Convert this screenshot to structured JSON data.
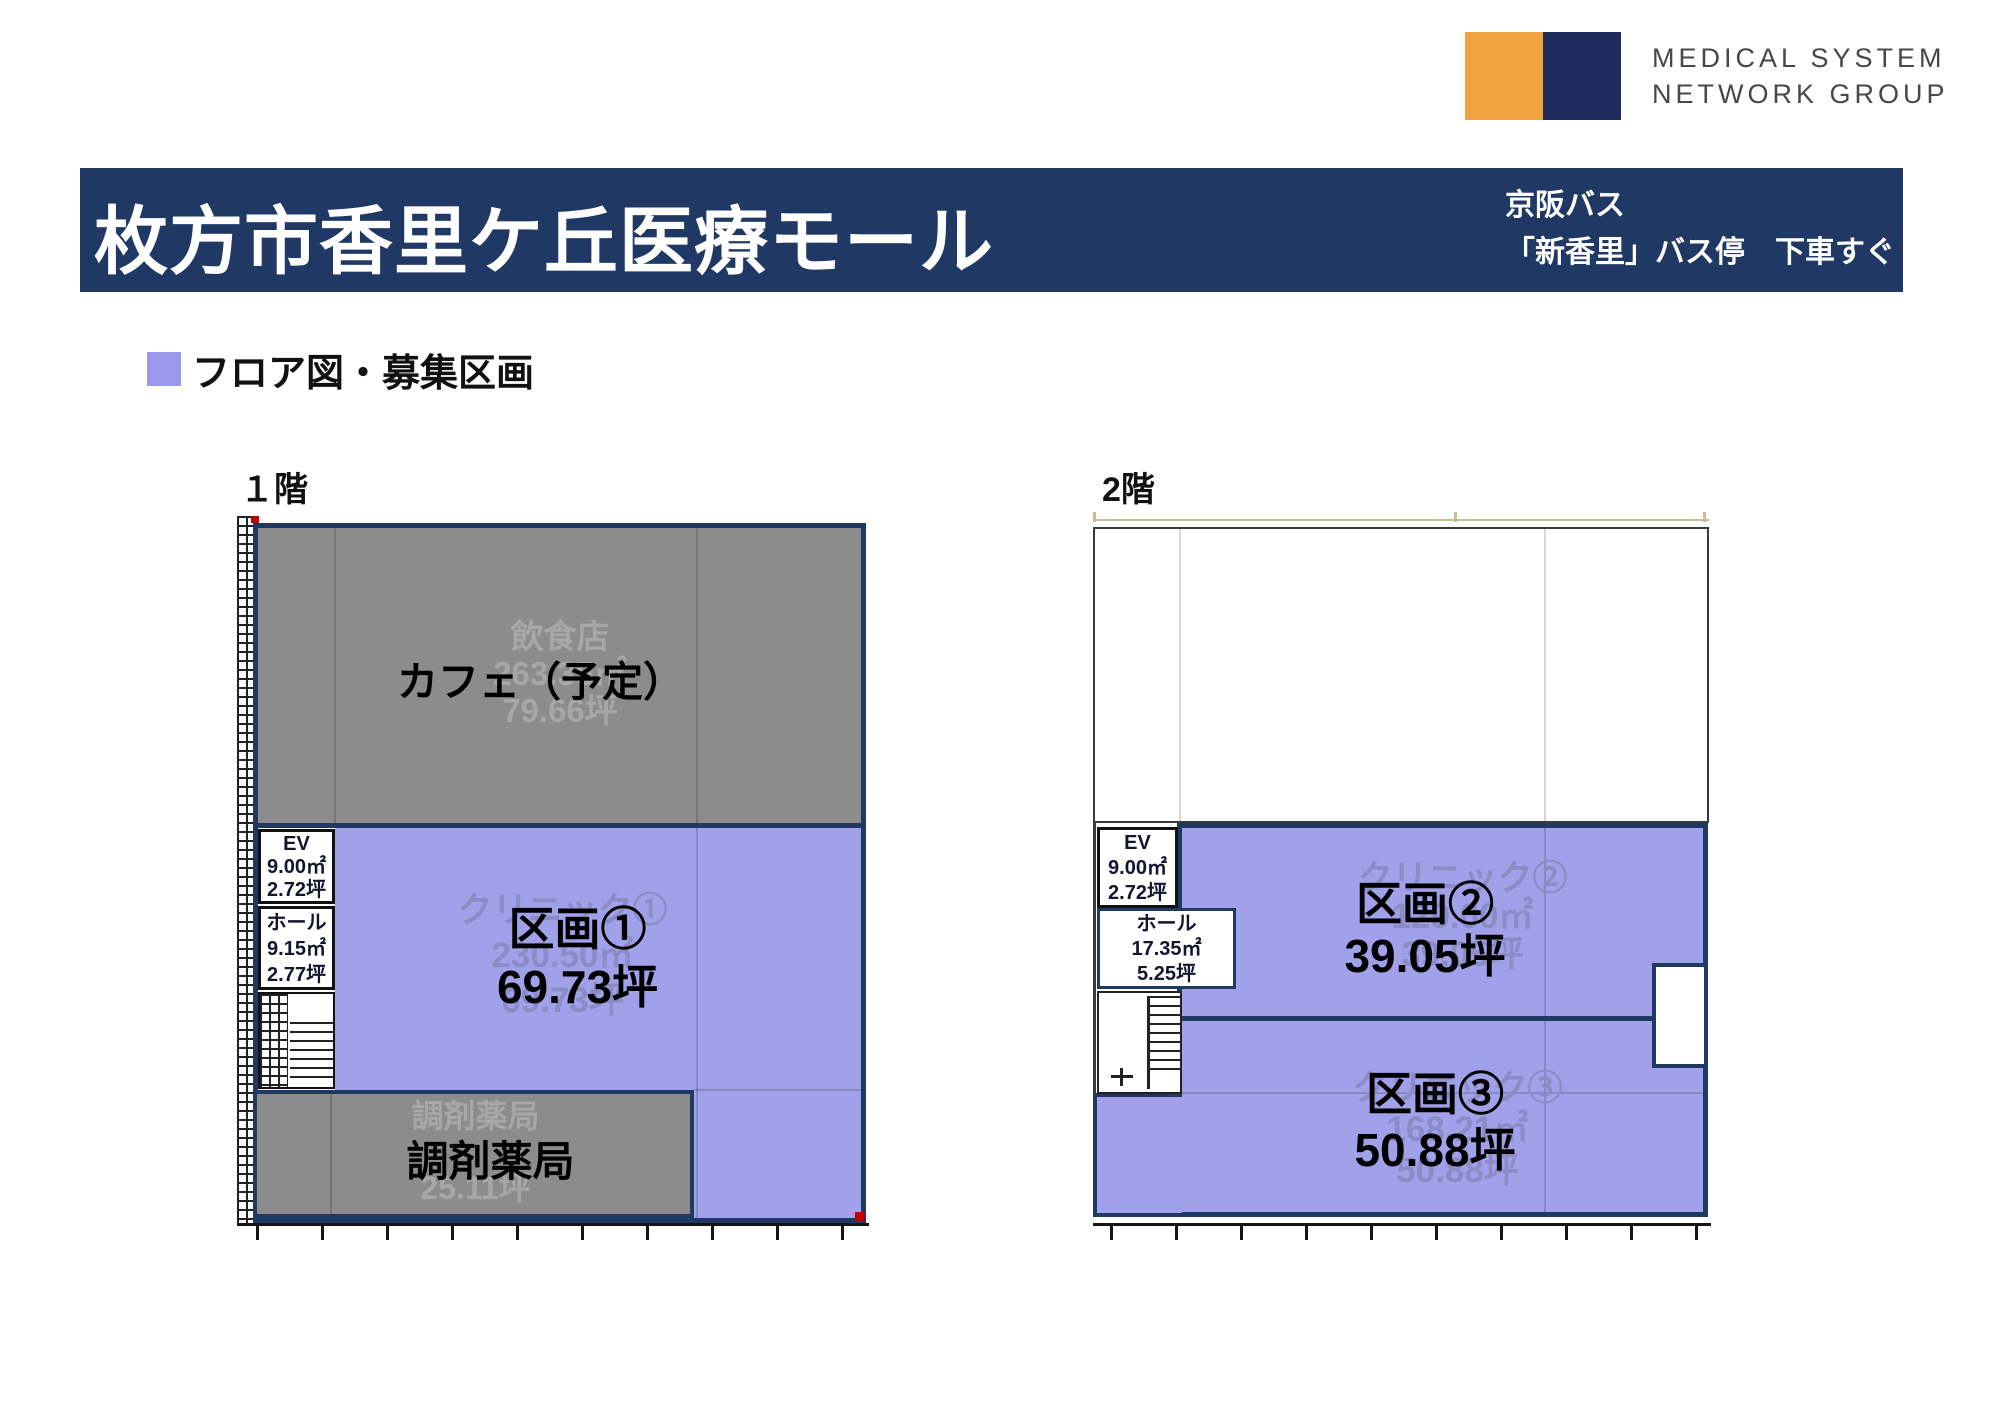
{
  "logo": {
    "orange": "#F0A33C",
    "navy": "#1E2B5C",
    "line1": "MEDICAL SYSTEM",
    "line2": "NETWORK GROUP"
  },
  "header": {
    "bg": "#1F3864",
    "title": "枚方市香里ケ丘医療モール",
    "access_line1": "京阪バス",
    "access_line2": "「新香里」バス停　下車すぐ"
  },
  "section": {
    "bullet_color": "#9999EC",
    "heading": "フロア図・募集区画"
  },
  "floor1": {
    "label": "１階",
    "cafe": {
      "faded1": "飲食店",
      "faded2": "263.35㎡",
      "faded3": "79.66坪",
      "bold": "カフェ（予定）"
    },
    "ev": {
      "l1": "EV",
      "l2": "9.00㎡",
      "l3": "2.72坪"
    },
    "hall": {
      "l1": "ホール",
      "l2": "9.15㎡",
      "l3": "2.77坪"
    },
    "unit1": {
      "faded1": "クリニック①",
      "faded2": "230.50㎡",
      "faded3": "69.73坪",
      "bold1": "区画①",
      "bold2": "69.73坪"
    },
    "pharmacy": {
      "faded1": "調剤薬局",
      "faded2": "25.11坪",
      "bold": "調剤薬局"
    }
  },
  "floor2": {
    "label": "2階",
    "ev": {
      "l1": "EV",
      "l2": "9.00㎡",
      "l3": "2.72坪"
    },
    "hall": {
      "l1": "ホール",
      "l2": "17.35㎡",
      "l3": "5.25坪"
    },
    "unit2": {
      "faded1": "クリニック②",
      "faded2": "129.00㎡",
      "faded3": "39.05坪",
      "bold1": "区画②",
      "bold2": "39.05坪"
    },
    "unit3": {
      "faded1": "クリニック③",
      "faded2": "168.21㎡",
      "faded3": "50.88坪",
      "bold1": "区画③",
      "bold2": "50.88坪"
    }
  },
  "colors": {
    "navy": "#1F3864",
    "purple": "#A1A1EA",
    "gray": "#8C8C8C"
  }
}
